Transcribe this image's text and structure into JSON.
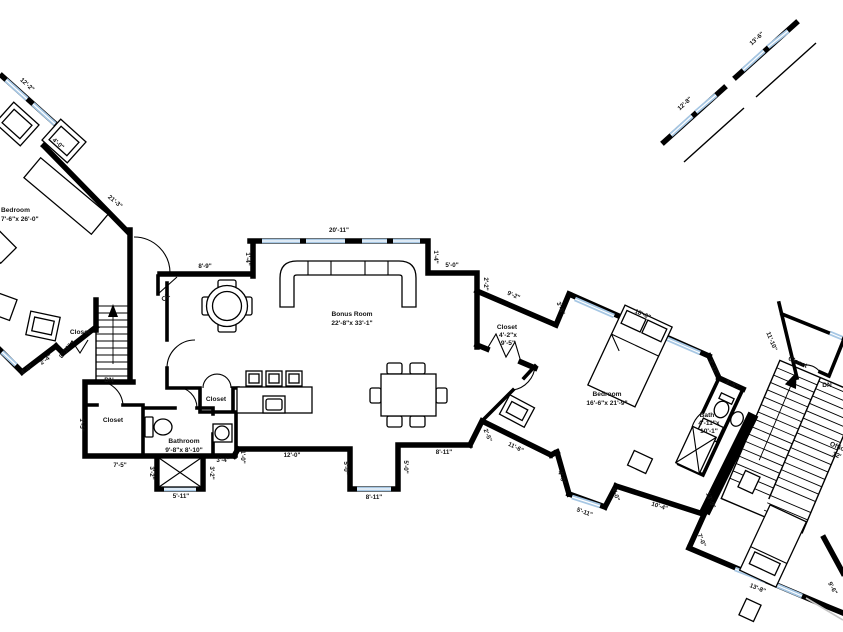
{
  "plan_type": "floor-plan",
  "colors": {
    "wall": "#000000",
    "window": "#a6c7e4",
    "window_center": "#ffffff",
    "faint_line": "#c4c4c4",
    "text": "#141414",
    "background": "#ffffff"
  },
  "rooms": {
    "bedroom_left": {
      "label": "Bedroom",
      "size": "7'-6\"x 26'-0\""
    },
    "bonus": {
      "label": "Bonus Room",
      "size": "22'-8\"x 33'-1\""
    },
    "bedroom_right": {
      "label": "Bedroom",
      "size": "16'-6\"x 21'-9\""
    },
    "bathroom": {
      "label": "Bathroom",
      "size": "9'-8\"x 8'-10\""
    },
    "bath": {
      "label": "Bath",
      "size_l1": "4'-11\"x",
      "size_l2": "10'-1\""
    },
    "closet_corridor": {
      "label": "Closet",
      "size_l1": "4'-2\"x",
      "size_l2": "9'-5\""
    },
    "office": {
      "label": "Office",
      "size": "12'"
    },
    "closet_upper_left": {
      "label": "Closet"
    },
    "closet_lower_left": {
      "label": "Closet"
    },
    "closet_kitchen": {
      "label": "Closet"
    },
    "closet_right": {
      "label": "Closet"
    },
    "cl_closet": {
      "label": "CL"
    },
    "stairs_left": {
      "label": "DN"
    },
    "stairs_right": {
      "label": "DN"
    }
  },
  "dimensions": {
    "win_top_left": "12'-2\"",
    "jog_top_left": "4'-0\"",
    "wall_top_left": "21'-3\"",
    "ext_a": "4'-0\"",
    "ext_b": "2'-4\"",
    "ext_c": "8'-10\"",
    "closet_left_h": "1'-5\"",
    "closet_left_w": "7'-5\"",
    "tub_l": "3'-2\"",
    "tub_r": "3'-2\"",
    "tub_win": "5'-11\"",
    "bath_step": "3'-4\"",
    "kitchen_step": "1'-0\"",
    "kitchen_wall": "12'-0\"",
    "bonus_left_jog": "8'-9\"",
    "bonus_left_step": "1'-4\"",
    "bonus_top": "20'-11\"",
    "bonus_right_step": "1'-4\"",
    "bonus_right_jog": "5'-0\"",
    "corridor_step": "2'-2\"",
    "corridor_top": "9'-2\"",
    "corridor_end": "3'-6\"",
    "br_window": "18'-6\"",
    "br_jog1": "3'-11\"",
    "br_jog2": "3'-5\"",
    "bump_l": "5'-0\"",
    "bump_r": "5'-0\"",
    "bump_win": "8'-11\"",
    "bonus_bottom": "8'-11\"",
    "se_jog": "2'-5\"",
    "se_diag": "11'-6\"",
    "br_bump_l": "4'-0\"",
    "br_bump_win": "5'-11\"",
    "br_bump_r": "4'-0\"",
    "br_bottom": "10'-4\"",
    "wall_13_9": "13'-9\"",
    "wall_7_0": "7'-0\"",
    "brb_win": "13'-8\"",
    "brb_right": "9'-6\"",
    "closet_right_wall": "11'-10\"",
    "deck_a": "12'-8\"",
    "deck_b": "13'-6\""
  }
}
